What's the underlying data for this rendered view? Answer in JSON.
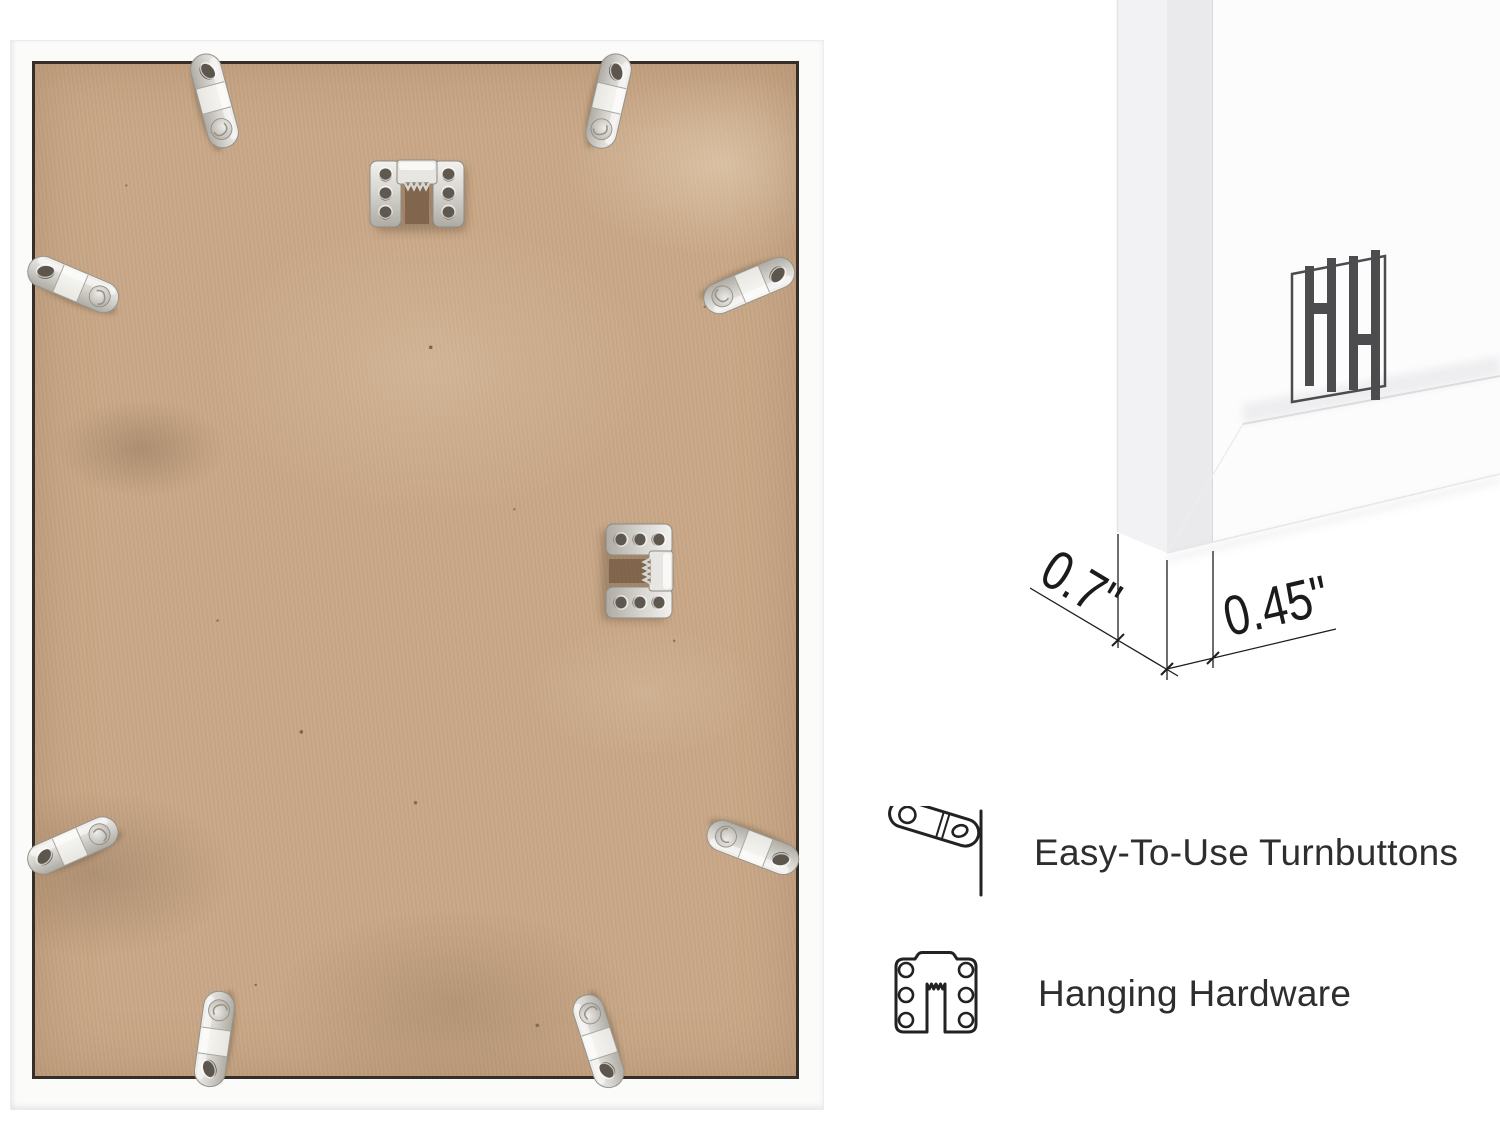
{
  "photo": {
    "name": "frame-back-photo",
    "board_color": "#c9a887",
    "frame_color": "#fbfbfa",
    "hardware_icons": [
      "turnbutton-top-left",
      "turnbutton-top-right",
      "turnbutton-left-upper",
      "turnbutton-right-upper",
      "turnbutton-left-lower",
      "turnbutton-right-lower",
      "turnbutton-bottom-left",
      "turnbutton-bottom-right",
      "sawtooth-hanger-top",
      "sawtooth-hanger-middle"
    ]
  },
  "corner_detail": {
    "name": "frame-corner-3d-detail",
    "logo_icon": "hh-brand-logo",
    "dimensions": {
      "depth": "0.7\"",
      "face_width": "0.45\""
    }
  },
  "features": [
    {
      "icon": "turnbutton-icon",
      "label": "Easy-To-Use Turnbuttons"
    },
    {
      "icon": "hanging-hardware-icon",
      "label": "Hanging Hardware"
    }
  ],
  "colors": {
    "metal": "#c9c6c0",
    "line_art": "#222222",
    "dimension_text": "#1b1b1b",
    "logo": "#4c4c4f",
    "board_gap_line": "#362f29"
  }
}
